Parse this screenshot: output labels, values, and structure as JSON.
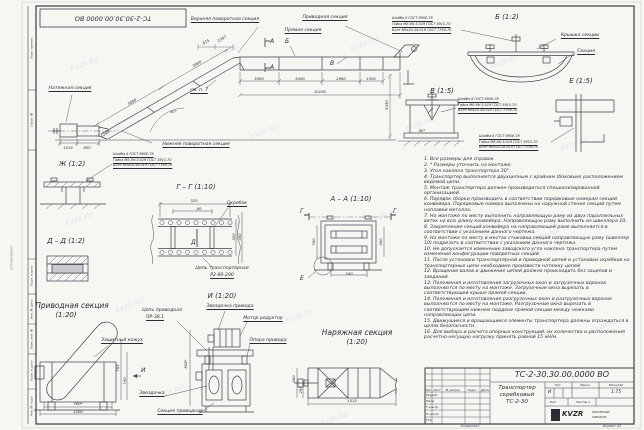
{
  "sheet": {
    "doc_number": "ТС-2-30.30.00.0000 ВО",
    "watermark": "KVZR.RU",
    "format_note": "Формат А2",
    "copied_note": "Копировал",
    "margin_left_note": "Согласовано",
    "side_labels": [
      "Перв. примен.",
      "Справ. №",
      "Подп. и дата",
      "Инв. № дубл.",
      "Взам. инв. №",
      "Подп. и дата",
      "Инв. № подл."
    ]
  },
  "overview": {
    "labels": {
      "upper_turn": "Верхняя поворотная секция",
      "drive": "Приводная секция",
      "straight": "Прямая секция",
      "tension": "Натяжная секция",
      "lower_turn": "Нижняя поворотная секция",
      "see_note": "см. п. 7"
    },
    "marks": {
      "a": "А",
      "b": "Б",
      "v": "В"
    },
    "dims": {
      "run1": "3000",
      "run2": "3000",
      "run3": "2660",
      "run4": "1500",
      "total": "10165",
      "height": "5430",
      "incline1": "3000",
      "incline2": "3000",
      "top1": "615",
      "top2": "1347",
      "left1": "1515",
      "left2": "850",
      "left3": "1249",
      "angle": "30°"
    }
  },
  "fasteners": {
    "washer": "Шайба 8 ГОСТ 6958-78",
    "nut": "Гайка М8-6Н.5.019 ГОСТ 5915-70",
    "bolt": "Болт М8х25.58.019 ГОСТ 7798-70"
  },
  "details": {
    "b": {
      "title": "Б (1:2)",
      "cover": "Крышка секции",
      "section": "Секция"
    },
    "v": {
      "title": "В (1:5)",
      "angle": "90°"
    },
    "e": {
      "title": "Е (1:5)"
    },
    "zh": {
      "title": "Ж (1:2)"
    },
    "gg": {
      "title": "Г – Г (1:10)",
      "scraper": "Скребок",
      "chain_line1": "Цепь транспортерная",
      "chain_line2": "Р2-80-290",
      "mark": "Д",
      "dim_w": "320",
      "dim_p": "80",
      "dim_h1": "320",
      "dim_h2": "460"
    },
    "dd": {
      "title": "Д – Д (1:2)"
    },
    "aa": {
      "title": "А – А (1:10)",
      "mark_g": "Г",
      "mark_e": "Е",
      "dim_left": "700",
      "dim_right": "360",
      "dim_bottom": "340"
    },
    "i_view": {
      "title": "И (1:20)",
      "mark": "И"
    },
    "drive": {
      "title": "Приводная секция",
      "scale": "(1:20)",
      "casing": "Защитный кожух",
      "chain_line1": "Цепь приводная",
      "chain_line2": "ПР-38,1",
      "drive_sprocket": "Звездочка привода",
      "motor": "Мотор редуктор",
      "support": "Опора привода",
      "sprocket": "Звездочка",
      "section": "Секция приводная",
      "dim_w1": "780*",
      "dim_w2": "1500",
      "dim_h1": "765",
      "dim_h2": "740",
      "dim_h3": "808*"
    },
    "tension": {
      "title": "Наряжная секция",
      "scale": "(1:20)",
      "dim_w": "1515",
      "dim_h1": "560",
      "dim_h2": "295"
    }
  },
  "notes": {
    "items": [
      "1. Все размеры для справок.",
      "2. * Размеры уточнить на монтаже.",
      "3. Угол наклона транспортера 30°.",
      "4. Транспортер выполняется двухцепным с крайним (боковым) расположением ведомой цепи.",
      "5. Монтаж транспортера должен производиться специализированной организацией.",
      "6. Порядок сборки производить в соответствии порядковым номерам секций конвейера. Порядковые номера выполнены на наружной стенке секций путем наплавки металла.",
      "7. На монтаже по месту выполнить направляющую раму из двух параллельных веток на всю длину конвейера. Направляющую раму выполнить из швеллера 10.",
      "8. Закрепление секций конвейера на направляющей раме выполняется в соответствии с указанием данного чертежа.",
      "9. На монтаже по месту в местах стыковки секций направляющую раму (швеллер 10) подрезать в соответствии с указанием данного чертежа.",
      "10. Не допускается изменение заводского угла наклона транспортера путем изменения конфигурации поворотных секций.",
      "11. После установки транспортерной и приводной цепей и установки скребков на транспортерные цепи необходимо произвести натяжку цепей.",
      "12. Вращение валов и движение цепей должно происходить без зацепов и заеданий.",
      "13. Положения и изготовления загрузочных окон и загрузочных воронок выполняются по месту на монтаже. Загрузочные окна вырезать в соответствующей крыше прямой секции.",
      "14. Положения и изготовления разгрузочных окон и разгрузочных воронок выполняются по месту на монтаже. Разгрузочные окна вырезать в соответствующем нижнем поддоне прямой секции между ножками направляющих цепи.",
      "15. Движущиеся и вращающиеся элементы транспортера должны ограждаться в целях безопасности.",
      "16. Для выбора и расчета опорных конструкций, их количества и расположения расчетно-несущую нагрузку принять равной 15 кН/м."
    ]
  },
  "titleblock": {
    "doc_number": "ТС-2-30.30.00.0000 ВО",
    "name_line1": "Транспортер",
    "name_line2": "скребковый",
    "name_line3": "ТС-2-30",
    "col_izm": "Изм.",
    "col_list": "Лист",
    "col_doc": "№ докум.",
    "col_sign": "Подп.",
    "col_date": "Дата",
    "role1": "Разраб.",
    "role2": "Пров.",
    "role3": "Т.контр.",
    "role4": "Н.контр.",
    "role5": "Утв.",
    "lit_header": "Лит.",
    "mass_header": "Масса",
    "scale_header": "Масштаб",
    "lit_value": "И",
    "scale_value": "1:75",
    "sheet_label": "Лист",
    "sheets_label": "Листов 1",
    "logo_text": "KVZR",
    "logo_sub1": "КОТЕЛЬНЫЙ",
    "logo_sub2": "ЗАВОД РФ"
  }
}
